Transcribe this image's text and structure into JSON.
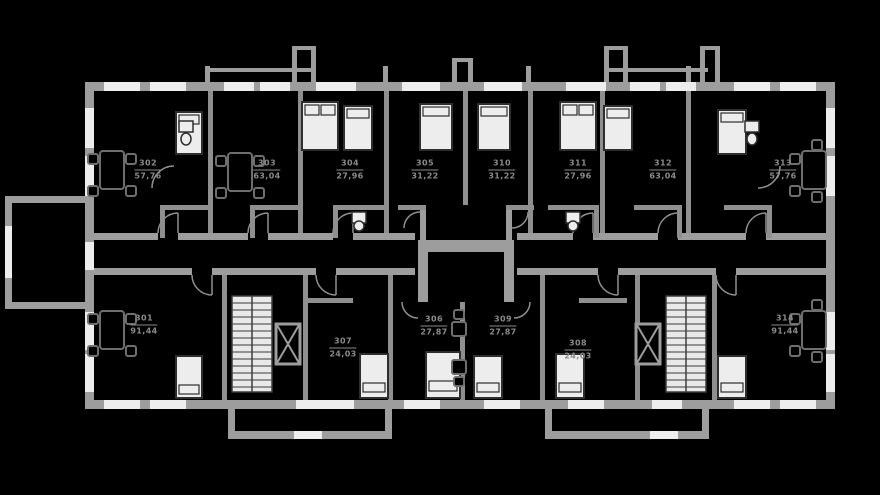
{
  "plan": {
    "type": "residential-floor-plan",
    "units_count": 14
  },
  "colors": {
    "background": "#000000",
    "wall": "#9d9d9d",
    "partition": "#8f8f8f",
    "label_text": "#8a8a8a",
    "furniture_fill": "#ededed",
    "furniture_stroke": "#2e2e2e"
  },
  "apartments": [
    {
      "number": "301",
      "area": "91,44"
    },
    {
      "number": "302",
      "area": "57,76"
    },
    {
      "number": "303",
      "area": "63,04"
    },
    {
      "number": "304",
      "area": "27,96"
    },
    {
      "number": "305",
      "area": "31,22"
    },
    {
      "number": "306",
      "area": "27,87"
    },
    {
      "number": "307",
      "area": "24,03"
    },
    {
      "number": "308",
      "area": "24,03"
    },
    {
      "number": "309",
      "area": "27,87"
    },
    {
      "number": "310",
      "area": "31,22"
    },
    {
      "number": "311",
      "area": "27,96"
    },
    {
      "number": "312",
      "area": "63,04"
    },
    {
      "number": "313",
      "area": "57,76"
    },
    {
      "number": "314",
      "area": "91,44"
    }
  ]
}
